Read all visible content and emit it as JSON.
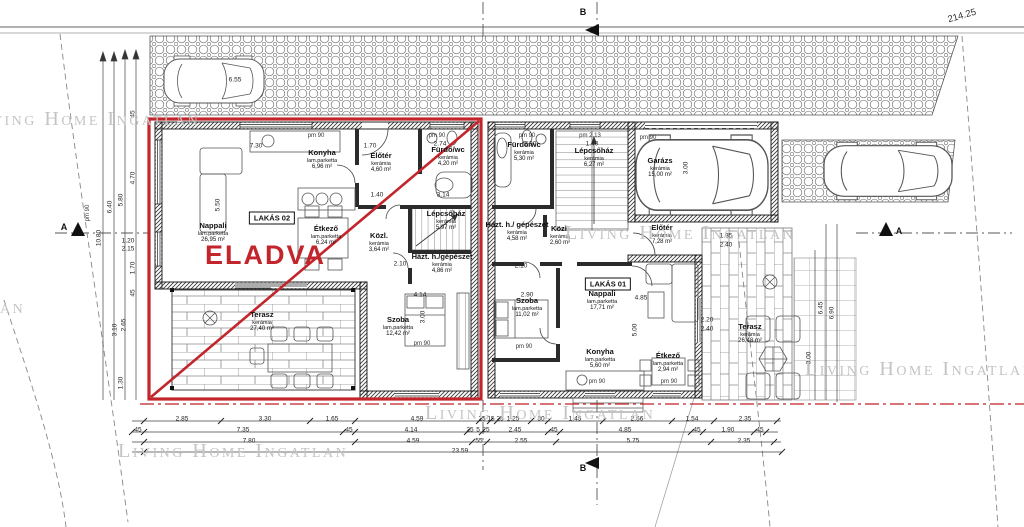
{
  "watermark": "Living Home Ingatlan",
  "plan": {
    "sold_label": "ELADVA",
    "sold_color": "#c2262c",
    "elevation_mark": "214.25"
  },
  "watermarks": [
    {
      "x": -30,
      "y": 108
    },
    {
      "x": -205,
      "y": 296
    },
    {
      "x": 565,
      "y": 222
    },
    {
      "x": 805,
      "y": 358
    },
    {
      "x": 118,
      "y": 440
    },
    {
      "x": 425,
      "y": 402
    }
  ],
  "apartments": [
    {
      "label": "LAKÁS 02",
      "box": {
        "x": 272,
        "y": 218
      },
      "rooms": [
        {
          "n": "Nappali",
          "f": "lam.parketta",
          "a": "26,95 m²",
          "x": 213,
          "y": 233
        },
        {
          "n": "Konyha",
          "f": "lam.parketta",
          "a": "6,96 m²",
          "x": 322,
          "y": 160
        },
        {
          "n": "Étkező",
          "f": "lam.parketta",
          "a": "6,24 m²",
          "x": 326,
          "y": 236
        },
        {
          "n": "Előtér",
          "f": "kerámia",
          "a": "4,60 m²",
          "x": 381,
          "y": 163
        },
        {
          "n": "Fürdő/wc",
          "f": "kerámia",
          "a": "4,20 m²",
          "x": 448,
          "y": 157
        },
        {
          "n": "Lépcsőház",
          "f": "kerámia",
          "a": "5,97 m²",
          "x": 446,
          "y": 221
        },
        {
          "n": "Közl.",
          "f": "kerámia",
          "a": "3,64 m²",
          "x": 379,
          "y": 243
        },
        {
          "n": "Házt. h./gépészet",
          "f": "kerámia",
          "a": "4,86 m²",
          "x": 442,
          "y": 264
        },
        {
          "n": "Szoba",
          "f": "lam.parketta",
          "a": "12,42 m²",
          "x": 398,
          "y": 327
        },
        {
          "n": "Terasz",
          "f": "kerámia",
          "a": "27,40 m²",
          "x": 262,
          "y": 322
        }
      ]
    },
    {
      "label": "LAKÁS 01",
      "box": {
        "x": 608,
        "y": 284
      },
      "rooms": [
        {
          "n": "Fürdő/wc",
          "f": "kerámia",
          "a": "5,30 m²",
          "x": 524,
          "y": 152
        },
        {
          "n": "Lépcsőház",
          "f": "kerámia",
          "a": "6,27 m²",
          "x": 594,
          "y": 158
        },
        {
          "n": "Garázs",
          "f": "kerámia",
          "a": "15,00 m²",
          "x": 660,
          "y": 168
        },
        {
          "n": "Házt. h./ gépészet",
          "f": "kerámia",
          "a": "4,58 m²",
          "x": 517,
          "y": 232
        },
        {
          "n": "Közl.",
          "f": "kerámia",
          "a": "2,60 m²",
          "x": 560,
          "y": 236
        },
        {
          "n": "Előtér",
          "f": "kerámia",
          "a": "7,28 m²",
          "x": 662,
          "y": 235
        },
        {
          "n": "Nappali",
          "f": "lam.parketta",
          "a": "17,71 m²",
          "x": 602,
          "y": 301
        },
        {
          "n": "Konyha",
          "f": "lam.parketta",
          "a": "5,60 m²",
          "x": 600,
          "y": 359
        },
        {
          "n": "Étkező",
          "f": "lam.parketta",
          "a": "2,94 m²",
          "x": 668,
          "y": 363
        },
        {
          "n": "Szoba",
          "f": "lam.parketta",
          "a": "11,02 m²",
          "x": 527,
          "y": 308
        },
        {
          "n": "Terasz",
          "f": "kerámia",
          "a": "26,48 m²",
          "x": 750,
          "y": 334
        }
      ]
    }
  ],
  "texts": [
    {
      "t": "2.85",
      "x": 182,
      "y": 419
    },
    {
      "t": "3.30",
      "x": 265,
      "y": 419
    },
    {
      "t": "1.65",
      "x": 332,
      "y": 419
    },
    {
      "t": "4.59",
      "x": 417,
      "y": 419
    },
    {
      "t": "25",
      "x": 482,
      "y": 419
    },
    {
      "t": "15",
      "x": 491,
      "y": 419
    },
    {
      "t": "25",
      "x": 500,
      "y": 419
    },
    {
      "t": "1.25",
      "x": 513,
      "y": 419
    },
    {
      "t": "30",
      "x": 541,
      "y": 419
    },
    {
      "t": "1.45",
      "x": 575,
      "y": 419
    },
    {
      "t": "2.56",
      "x": 637,
      "y": 419
    },
    {
      "t": "1.54",
      "x": 692,
      "y": 419
    },
    {
      "t": "2.35",
      "x": 745,
      "y": 419
    },
    {
      "t": "45",
      "x": 138,
      "y": 430
    },
    {
      "t": "7.35",
      "x": 243,
      "y": 430
    },
    {
      "t": "45",
      "x": 349,
      "y": 430
    },
    {
      "t": "4.14",
      "x": 411,
      "y": 430
    },
    {
      "t": "25",
      "x": 470,
      "y": 430
    },
    {
      "t": "5",
      "x": 478,
      "y": 430
    },
    {
      "t": "25",
      "x": 486,
      "y": 430
    },
    {
      "t": "2.45",
      "x": 515,
      "y": 430
    },
    {
      "t": "45",
      "x": 554,
      "y": 430
    },
    {
      "t": "4.85",
      "x": 625,
      "y": 430
    },
    {
      "t": "45",
      "x": 697,
      "y": 430
    },
    {
      "t": "1.90",
      "x": 728,
      "y": 430
    },
    {
      "t": "45",
      "x": 760,
      "y": 430
    },
    {
      "t": "7.80",
      "x": 249,
      "y": 441
    },
    {
      "t": "4.59",
      "x": 413,
      "y": 441
    },
    {
      "t": "55",
      "x": 479,
      "y": 441
    },
    {
      "t": "2.55",
      "x": 521,
      "y": 441
    },
    {
      "t": "5.75",
      "x": 633,
      "y": 441
    },
    {
      "t": "2.35",
      "x": 744,
      "y": 441
    },
    {
      "t": "23.59",
      "x": 460,
      "y": 451
    },
    {
      "t": "10.80",
      "x": 99,
      "y": 238,
      "r": -90
    },
    {
      "t": "6.40",
      "x": 110,
      "y": 207,
      "r": -90
    },
    {
      "t": "5.80",
      "x": 121,
      "y": 200,
      "r": -90
    },
    {
      "t": "4.70",
      "x": 133,
      "y": 178,
      "r": -90
    },
    {
      "t": "45",
      "x": 133,
      "y": 114,
      "r": -90
    },
    {
      "t": "1.70",
      "x": 133,
      "y": 268,
      "r": -90
    },
    {
      "t": "2.65",
      "x": 124,
      "y": 325,
      "r": -90
    },
    {
      "t": "3.10",
      "x": 115,
      "y": 330,
      "r": -90
    },
    {
      "t": "1.30",
      "x": 121,
      "y": 383,
      "r": -90
    },
    {
      "t": "45",
      "x": 133,
      "y": 293,
      "r": -90
    },
    {
      "t": "1.20",
      "x": 128,
      "y": 241
    },
    {
      "t": "2.15",
      "x": 128,
      "y": 249
    },
    {
      "t": "6.45",
      "x": 821,
      "y": 308,
      "r": -90
    },
    {
      "t": "6.90",
      "x": 832,
      "y": 313,
      "r": -90
    },
    {
      "t": "3.00",
      "x": 809,
      "y": 358,
      "r": -90
    },
    {
      "t": "6.55",
      "x": 235,
      "y": 80
    },
    {
      "t": "7.30",
      "x": 256,
      "y": 146
    },
    {
      "t": "5.50",
      "x": 218,
      "y": 205,
      "r": -90
    },
    {
      "t": "1.70",
      "x": 370,
      "y": 146
    },
    {
      "t": "2.74",
      "x": 440,
      "y": 144
    },
    {
      "t": "2.90",
      "x": 530,
      "y": 144
    },
    {
      "t": "1.40",
      "x": 592,
      "y": 144
    },
    {
      "t": "1.40",
      "x": 377,
      "y": 195
    },
    {
      "t": "3.14",
      "x": 443,
      "y": 195
    },
    {
      "t": "2.10",
      "x": 400,
      "y": 264
    },
    {
      "t": "2.10",
      "x": 521,
      "y": 266
    },
    {
      "t": "4.14",
      "x": 420,
      "y": 295
    },
    {
      "t": "2.90",
      "x": 527,
      "y": 295
    },
    {
      "t": "3.00",
      "x": 423,
      "y": 317,
      "r": -90
    },
    {
      "t": "4.85",
      "x": 641,
      "y": 298
    },
    {
      "t": "5.00",
      "x": 635,
      "y": 330,
      "r": -90
    },
    {
      "t": "3.00",
      "x": 686,
      "y": 168,
      "r": -90
    },
    {
      "t": "2.20",
      "x": 707,
      "y": 320
    },
    {
      "t": "2.40",
      "x": 707,
      "y": 329
    },
    {
      "t": "1.35",
      "x": 726,
      "y": 236
    },
    {
      "t": "2.40",
      "x": 726,
      "y": 245
    },
    {
      "t": "pm 90",
      "x": 316,
      "y": 136,
      "k": "pm"
    },
    {
      "t": "pm 90",
      "x": 437,
      "y": 136,
      "k": "pm"
    },
    {
      "t": "pm 90",
      "x": 527,
      "y": 136,
      "k": "pm"
    },
    {
      "t": "pm 2.13",
      "x": 590,
      "y": 136,
      "k": "pm"
    },
    {
      "t": "pm 90",
      "x": 648,
      "y": 138,
      "k": "pm"
    },
    {
      "t": "pm 90",
      "x": 422,
      "y": 344,
      "k": "pm"
    },
    {
      "t": "pm 90",
      "x": 524,
      "y": 347,
      "k": "pm"
    },
    {
      "t": "pm 90",
      "x": 597,
      "y": 382,
      "k": "pm"
    },
    {
      "t": "pm 90",
      "x": 669,
      "y": 382,
      "k": "pm"
    },
    {
      "t": "pm 90",
      "x": 88,
      "y": 213,
      "r": -90,
      "k": "pm"
    },
    {
      "t": "A",
      "x": 64,
      "y": 227,
      "k": "mark"
    },
    {
      "t": "A",
      "x": 899,
      "y": 231,
      "k": "mark"
    },
    {
      "t": "B",
      "x": 583,
      "y": 12,
      "k": "mark"
    },
    {
      "t": "B",
      "x": 583,
      "y": 468,
      "k": "mark"
    },
    {
      "t": "214.25",
      "x": 962,
      "y": 16,
      "r": -16,
      "k": "elev"
    }
  ]
}
